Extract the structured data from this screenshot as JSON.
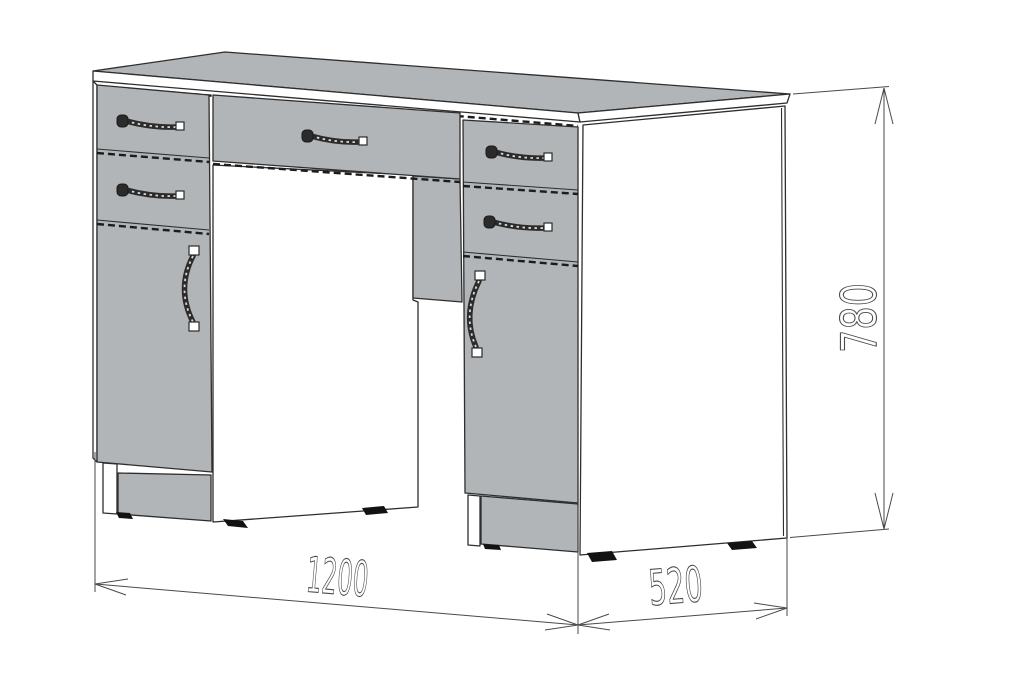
{
  "drawing": {
    "type": "furniture-dimension-drawing",
    "subject": "double-pedestal-desk",
    "dimension_labels": {
      "width": "1200",
      "depth": "520",
      "height": "780"
    }
  },
  "colors": {
    "furniture_gray": "#b2b5b7",
    "line": "#2e2e2e",
    "dim_line": "#4a4a4a",
    "background": "#ffffff"
  }
}
